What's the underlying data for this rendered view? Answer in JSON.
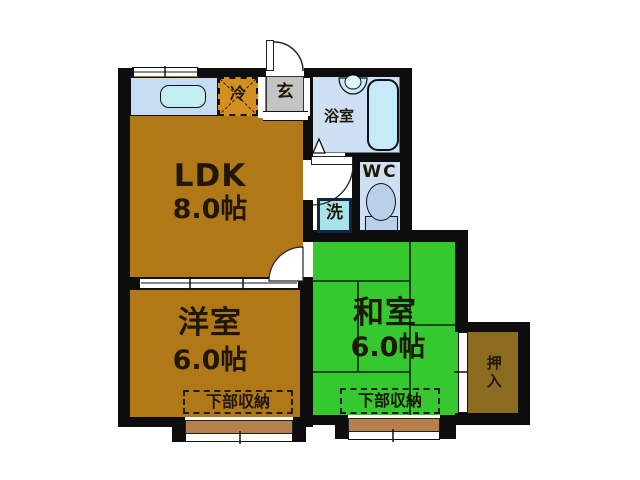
{
  "plan": {
    "type": "apartment-floor-plan",
    "rooms": {
      "ldk": {
        "name": "LDK",
        "size": "8.0帖"
      },
      "western_room": {
        "name": "洋室",
        "size": "6.0帖"
      },
      "japanese_room": {
        "name": "和室",
        "size": "6.0帖"
      },
      "bathroom": {
        "name": "浴室"
      },
      "toilet": {
        "name": "WC"
      },
      "entrance": {
        "name": "玄"
      },
      "closet": {
        "name": "押入"
      },
      "fridge_space": {
        "name": "冷"
      },
      "washer_space": {
        "name": "洗"
      },
      "storage_western": {
        "name": "下部収納"
      },
      "storage_japanese": {
        "name": "下部収納"
      }
    },
    "colors": {
      "wall": "#0d0d0d",
      "ldk_floor": "#b07816",
      "japanese_floor": "#35c92f",
      "closet_floor": "#8b6b1d",
      "balcony": "#b5804a",
      "fridge_box": "#d4901e",
      "entrance_floor": "#c4c4c4",
      "kitchen_counter": "#c6dcf2",
      "kitchen_sink": "#c2eef2",
      "bath_floor": "#cfe0f4",
      "bathtub": "#c6ebf8",
      "toilet_fixture": "#b9d0ea",
      "washer_box": "#a8e3ea",
      "washer_border": "#152441",
      "text": "#201807"
    }
  }
}
